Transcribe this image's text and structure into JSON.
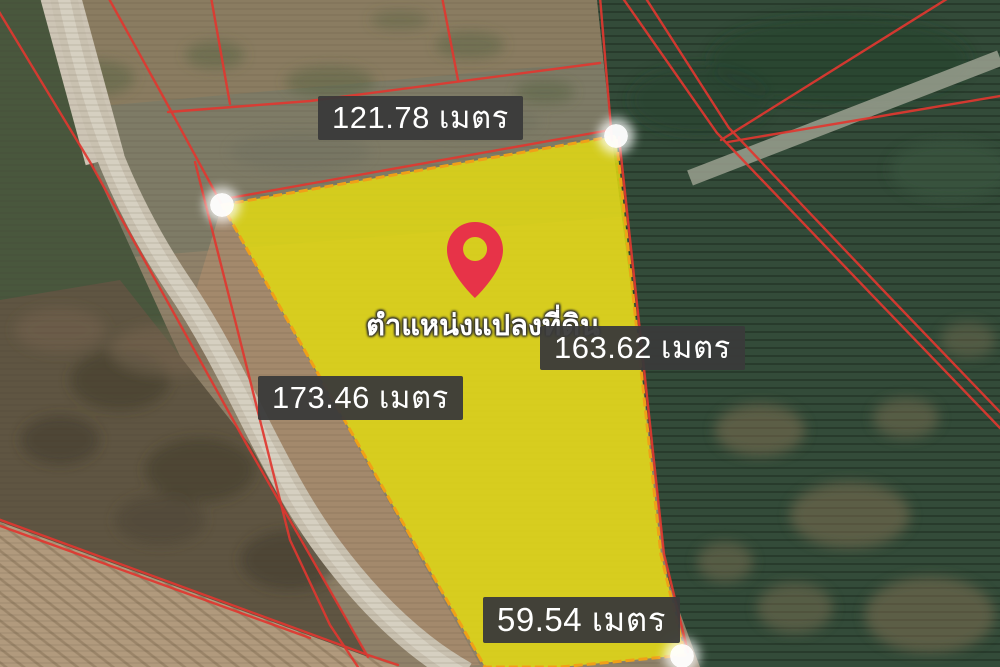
{
  "map_overlay": {
    "plot_caption": "ตำแหน่งแปลงที่ดิน",
    "measurements": {
      "north": "121.78 เมตร",
      "east": "163.62 เมตร",
      "west": "173.46 เมตร",
      "south": "59.54 เมตร"
    },
    "values": {
      "north": 121.78,
      "east": 163.62,
      "west": 173.46,
      "south": 59.54,
      "unit": "เมตร"
    },
    "corner_markers_visible": 3,
    "colors": {
      "plot_highlight": "#e6de0f",
      "plot_outline": "#f0a018",
      "cadastral_line": "#e03830",
      "label_background": "#3a3a3a",
      "label_text": "#ffffff",
      "pin": "#e73348"
    }
  }
}
